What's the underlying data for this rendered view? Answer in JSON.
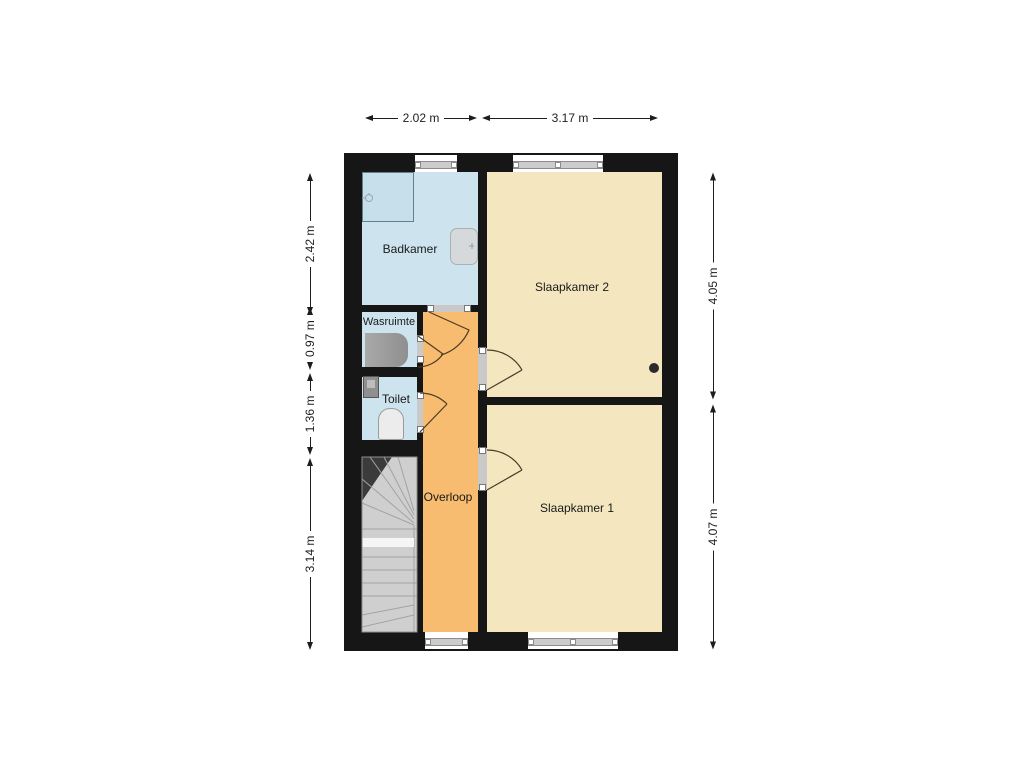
{
  "plan": {
    "type": "floor-plan",
    "rooms": {
      "badkamer": {
        "label": "Badkamer"
      },
      "wasruimte": {
        "label": "Wasruimte"
      },
      "toilet": {
        "label": "Toilet"
      },
      "overloop": {
        "label": "Overloop"
      },
      "slaapkamer2": {
        "label": "Slaapkamer 2"
      },
      "slaapkamer1": {
        "label": "Slaapkamer 1"
      }
    },
    "fixtures": [
      "shower",
      "bathtub",
      "washing-machine",
      "hand-basin",
      "toilet-bowl",
      "staircase",
      "point-marker"
    ],
    "dimensions": {
      "top": [
        {
          "label": "2.02 m"
        },
        {
          "label": "3.17 m"
        }
      ],
      "left": [
        {
          "label": "2.42 m"
        },
        {
          "label": "0.97 m"
        },
        {
          "label": "1.36 m"
        },
        {
          "label": "3.14 m"
        }
      ],
      "right": [
        {
          "label": "4.05 m"
        },
        {
          "label": "4.07 m"
        }
      ]
    },
    "colors": {
      "wall": "#161616",
      "wet_room": "#cde4ef",
      "bedroom": "#f4e7c0",
      "hallway": "#f7bc6f",
      "stairs": "#cfcfcf",
      "background": "#ffffff"
    }
  }
}
